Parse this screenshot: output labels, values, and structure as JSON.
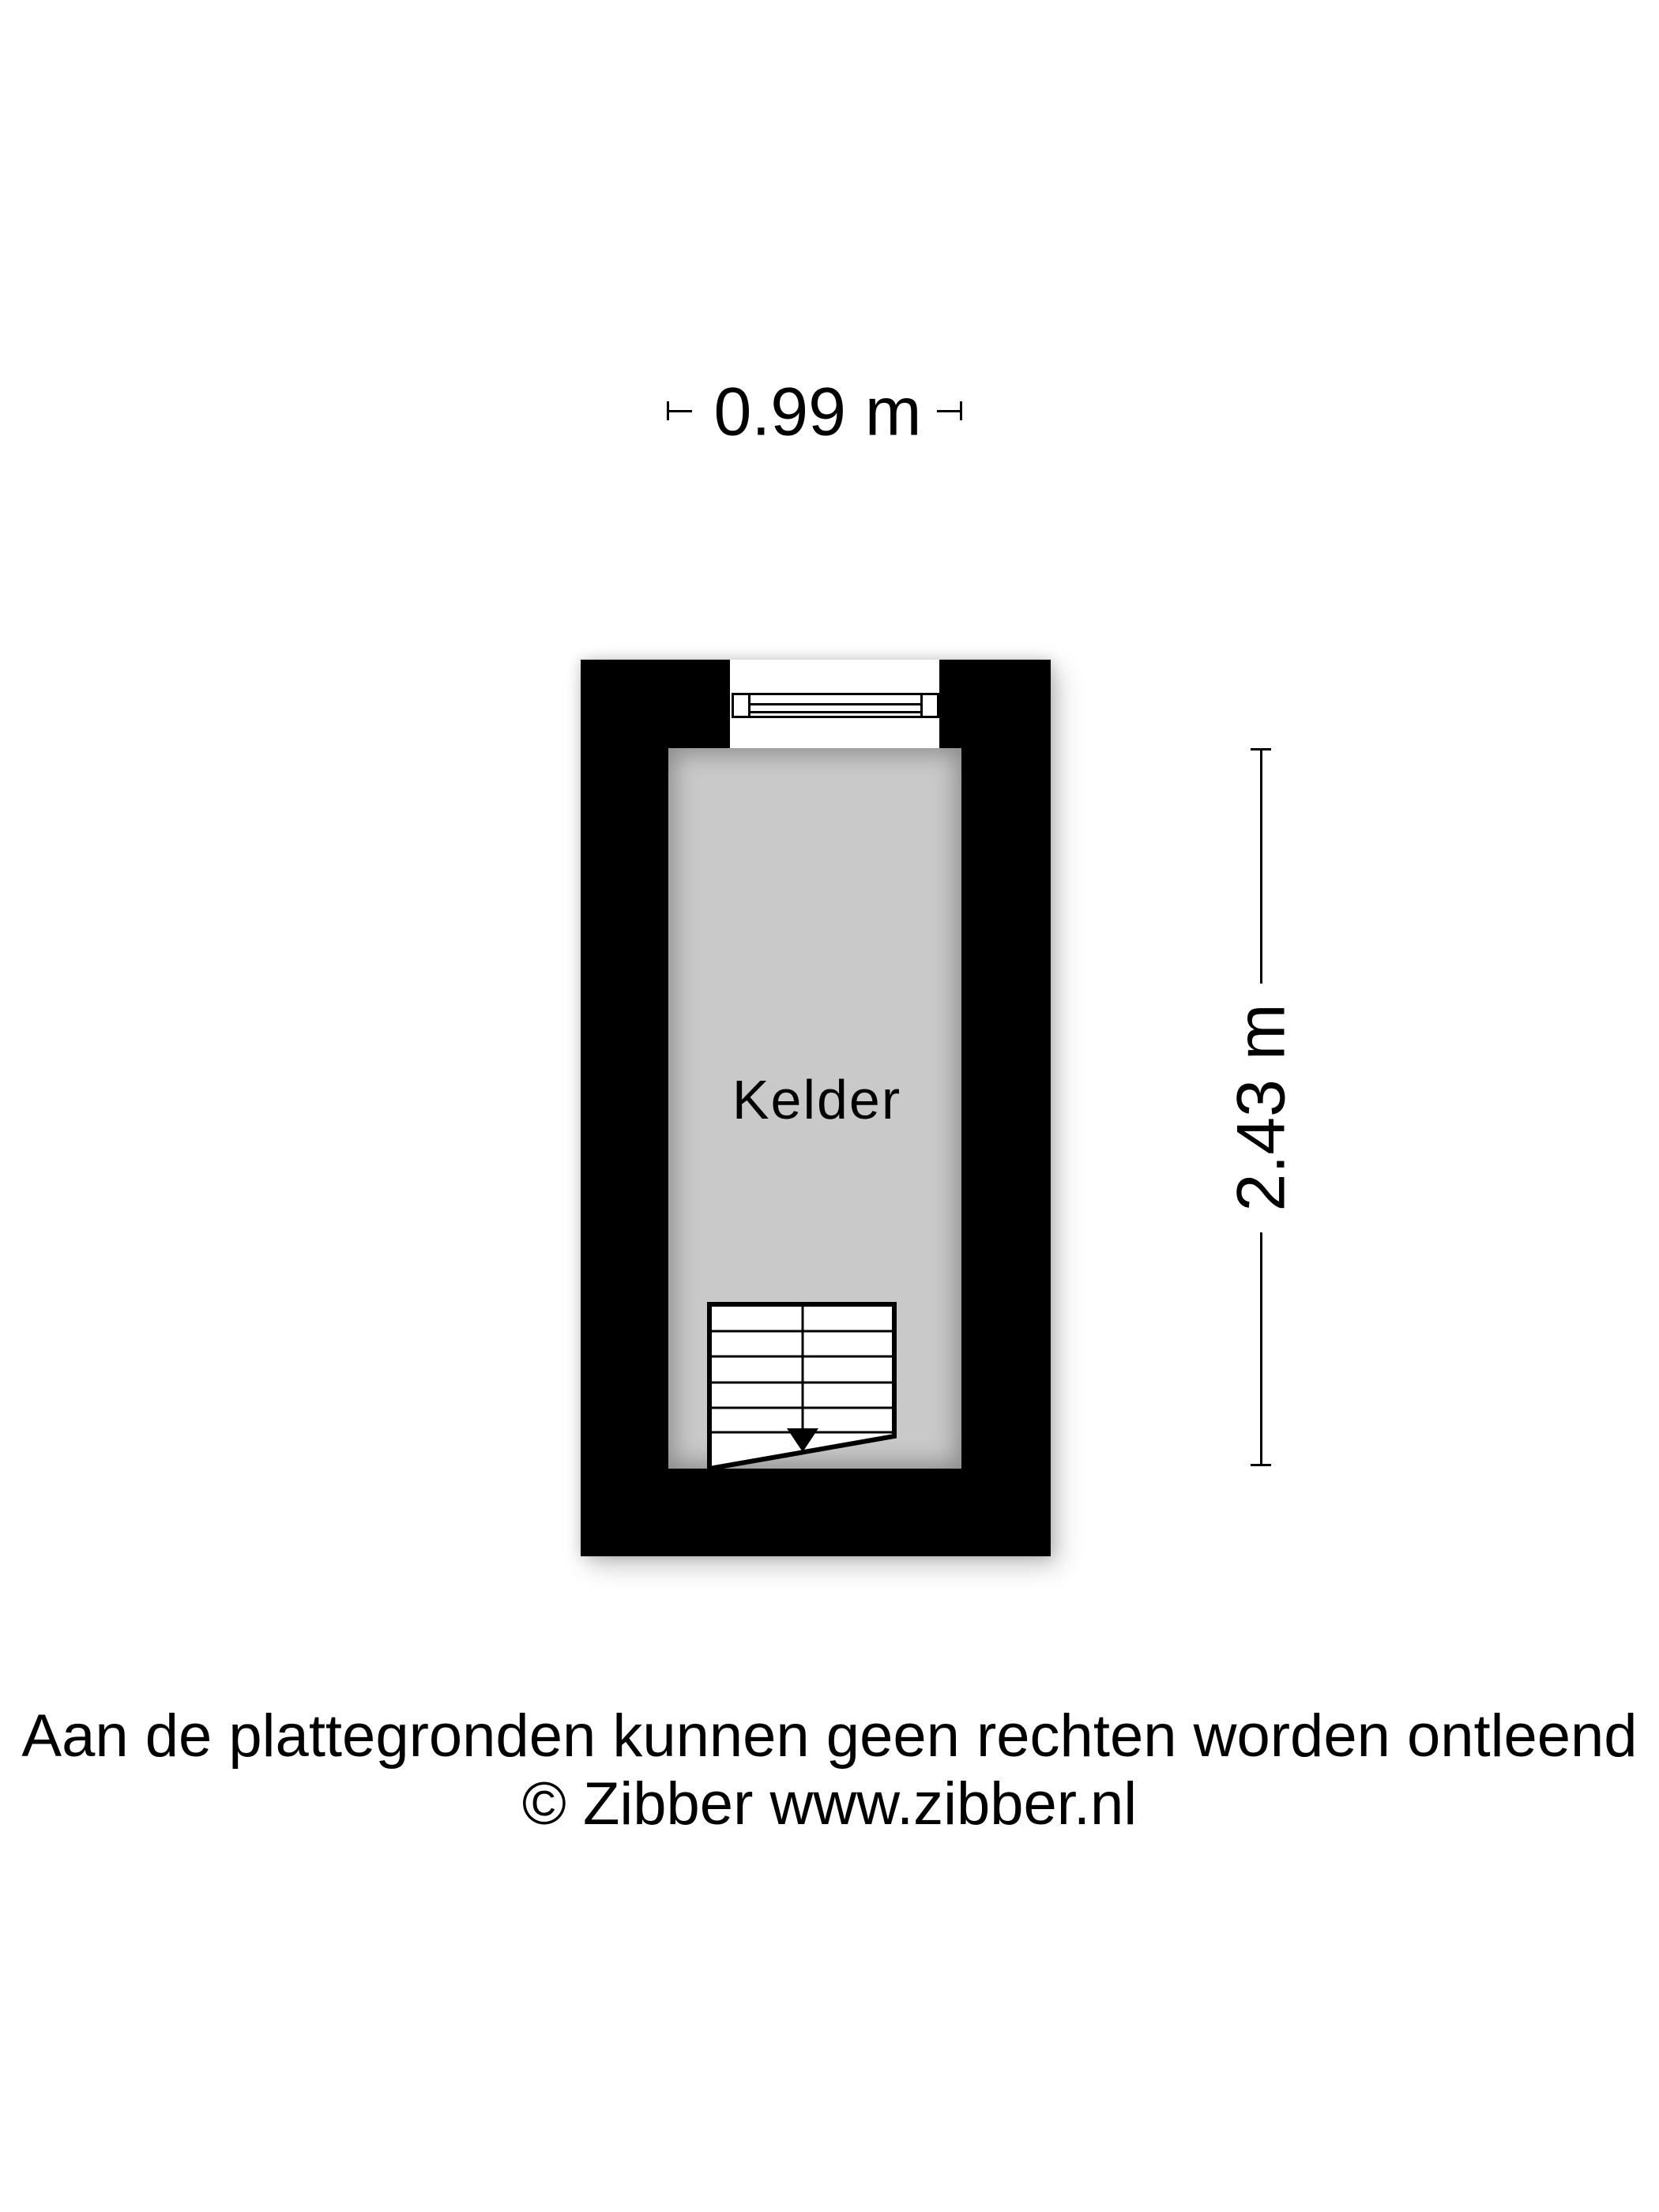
{
  "floorplan": {
    "room": {
      "label": "Kelder"
    },
    "dimensions": {
      "width": {
        "label": "0.99 m"
      },
      "height": {
        "label": "2.43 m"
      }
    },
    "features": {
      "window": "window-symbol",
      "stairs": "stairs-down-with-arrow"
    }
  },
  "footer": {
    "disclaimer": "Aan de plattegronden kunnen geen rechten worden ontleend",
    "copyright": "© Zibber www.zibber.nl"
  },
  "colors": {
    "wall": "#000000",
    "floor": "#c9c9c9",
    "line": "#000000",
    "text": "#000000",
    "background": "#ffffff"
  }
}
